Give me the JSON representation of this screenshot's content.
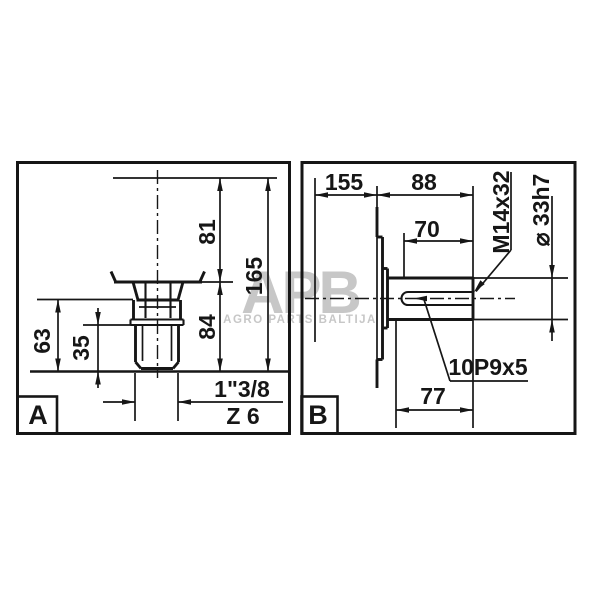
{
  "watermark": {
    "brand": "APB",
    "subtitle": "AGRO PARTS BALTIJA"
  },
  "panel_a": {
    "label": "A",
    "dim_81": "81",
    "dim_165": "165",
    "dim_84": "84",
    "dim_63": "63",
    "dim_35": "35",
    "spline_spec": "1\"3/8",
    "spline_count": "Z 6"
  },
  "panel_b": {
    "label": "B",
    "dim_155": "155",
    "dim_88": "88",
    "dim_70": "70",
    "dim_77": "77",
    "thread_spec": "M14x32",
    "diameter_spec": "⌀ 33h7",
    "keyway_spec": "10P9x5"
  },
  "colors": {
    "line": "#161616",
    "watermark": "#c7c7c7",
    "background": "#ffffff"
  }
}
